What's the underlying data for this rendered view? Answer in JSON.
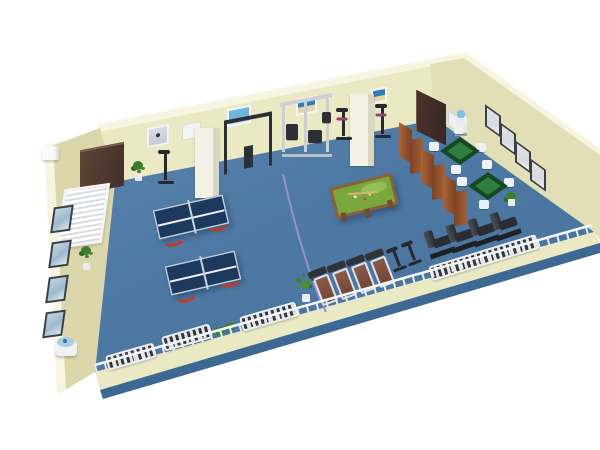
{
  "scene": {
    "label": "3D isometric floor plan of a recreation and fitness room",
    "background": "#ffffff"
  },
  "palette": {
    "wall": "#ebe8c4",
    "wallTop": "#f7f5e2",
    "wallSide": "#e2dfb6",
    "wallFront": "#dbd7ab",
    "slab": "#3c6892",
    "floorA": "#5e8ab4",
    "floorB": "#4e7aa5",
    "floorC": "#466f98",
    "pillar": "#f4f2e6",
    "pillarShade": "#d9d6c1",
    "doorA": "#5c4334",
    "doorB": "#44302a",
    "doorEdge": "#76594a",
    "doorRightA": "#4a332c",
    "doorRightB": "#372722",
    "frameDark": "#3a3e45",
    "picBlue": "#9db9cf",
    "picGray": "#d6dadd",
    "posterSky": "#6fb5dd",
    "posterSea": "#2f7fb5",
    "posterSand": "#e6d5a6",
    "windowFrame": "#f2f4f6",
    "windowSlat": "#d8dbde",
    "screenA": "#a35f36",
    "screenB": "#7c4323",
    "mahjongRim": "#16491f",
    "mahjongFelt": "#2f7d40",
    "chairWhite": "#edf1f4",
    "poolFelt": "#7aa83f",
    "poolFeltLight": "#97bf58",
    "poolWood": "#8a6138",
    "poolLeg": "#6e4c2c",
    "ppTop": "#1d3a5e",
    "ppLine": "#eef2f6",
    "ppNet": "#c9d5dd",
    "legRed": "#c23a28",
    "machineFrame": "#c9cfd6",
    "machineDark": "#2b2f36",
    "bikeDark": "#26292e",
    "bikeAccent": "#8d4470",
    "treadFrame": "#dde2e6",
    "treadBelt": "#8a5a48",
    "treadBeltDark": "#6e4537",
    "treadConsole": "#2f3338",
    "benchDark": "#2a2d33",
    "benchLight": "#4a4f57",
    "benchBase": "#1d2024",
    "radFrame": "#eef0f2",
    "radSlat": "#34373c",
    "plantGreen": "#3f7d2d",
    "plantDark": "#2d661f",
    "plantLight": "#4c8a38",
    "potWhite": "#e9edef",
    "dispBody": "#eef1f3",
    "dispBottle": "#7ac0e8",
    "dispBase": "#9aa0a6",
    "cord": "#9c8cd4",
    "fountainBody": "#eff2f4",
    "fountainBlue": "#a9cbe6",
    "fountainDot": "#3a6db0",
    "railWhite": "#f4f6f8",
    "railPost": "#e8ebee",
    "bagGreen": "#3f7d2f",
    "signWhite": "#eef1f3",
    "acWhite": "#fafaf6",
    "boardWhite": "#f2f4f0",
    "shadowCol": "rgba(15,35,65,0.35)"
  },
  "items": {
    "left_door": {
      "label": "Wooden door on back-left wall",
      "count": 1
    },
    "right_door": {
      "label": "Wooden door on back-right wall",
      "count": 1
    },
    "window": {
      "label": "Window with blinds on left wall",
      "count": 1
    },
    "ac_unit": {
      "label": "White wall box on outer left corner",
      "count": 1
    },
    "pillars": {
      "label": "Structural pillar",
      "count": 2
    },
    "whiteboard": {
      "label": "Whiteboard on back wall",
      "count": 1
    },
    "wall_sign": {
      "label": "Small wall sign",
      "count": 1
    },
    "back_posters": {
      "label": "Posters and framed pictures on back wall",
      "count": 4
    },
    "left_pictures": {
      "label": "Framed pictures on left wall",
      "count": 4
    },
    "right_pictures": {
      "label": "Framed pictures on right wall",
      "count": 4
    },
    "pull_up_station": {
      "label": "Pull-up frame station",
      "count": 1
    },
    "multi_gym": {
      "label": "Multi-station gym machine",
      "count": 1
    },
    "exercise_bikes": {
      "label": "Upright exercise bikes",
      "count": 5
    },
    "treadmills": {
      "label": "Treadmills",
      "count": 4
    },
    "weight_benches": {
      "label": "Dark weight benches",
      "count": 4
    },
    "ping_pong_tables": {
      "label": "Table tennis tables with red curved legs",
      "count": 2
    },
    "pool_table": {
      "label": "Billiard table with green felt",
      "count": 1
    },
    "mahjong_tables": {
      "label": "Mahjong table with chairs",
      "count": 2,
      "chairs_each": 4
    },
    "folding_screen": {
      "label": "Wooden folding screen partition",
      "panels": 6
    },
    "water_dispenser": {
      "label": "Water dispenser with blue bottle",
      "count": 1
    },
    "water_fountain": {
      "label": "Drinking fountain at left corner",
      "count": 1
    },
    "radiators": {
      "label": "White slatted radiator benches",
      "count": 4
    },
    "plants": {
      "label": "Potted plants",
      "count": 5
    },
    "bags": {
      "label": "Green gym bags",
      "count": 2
    },
    "floor_cable": {
      "label": "Purple cable across floor",
      "count": 1
    },
    "railing": {
      "label": "Railing along front edge",
      "count": 1
    }
  }
}
